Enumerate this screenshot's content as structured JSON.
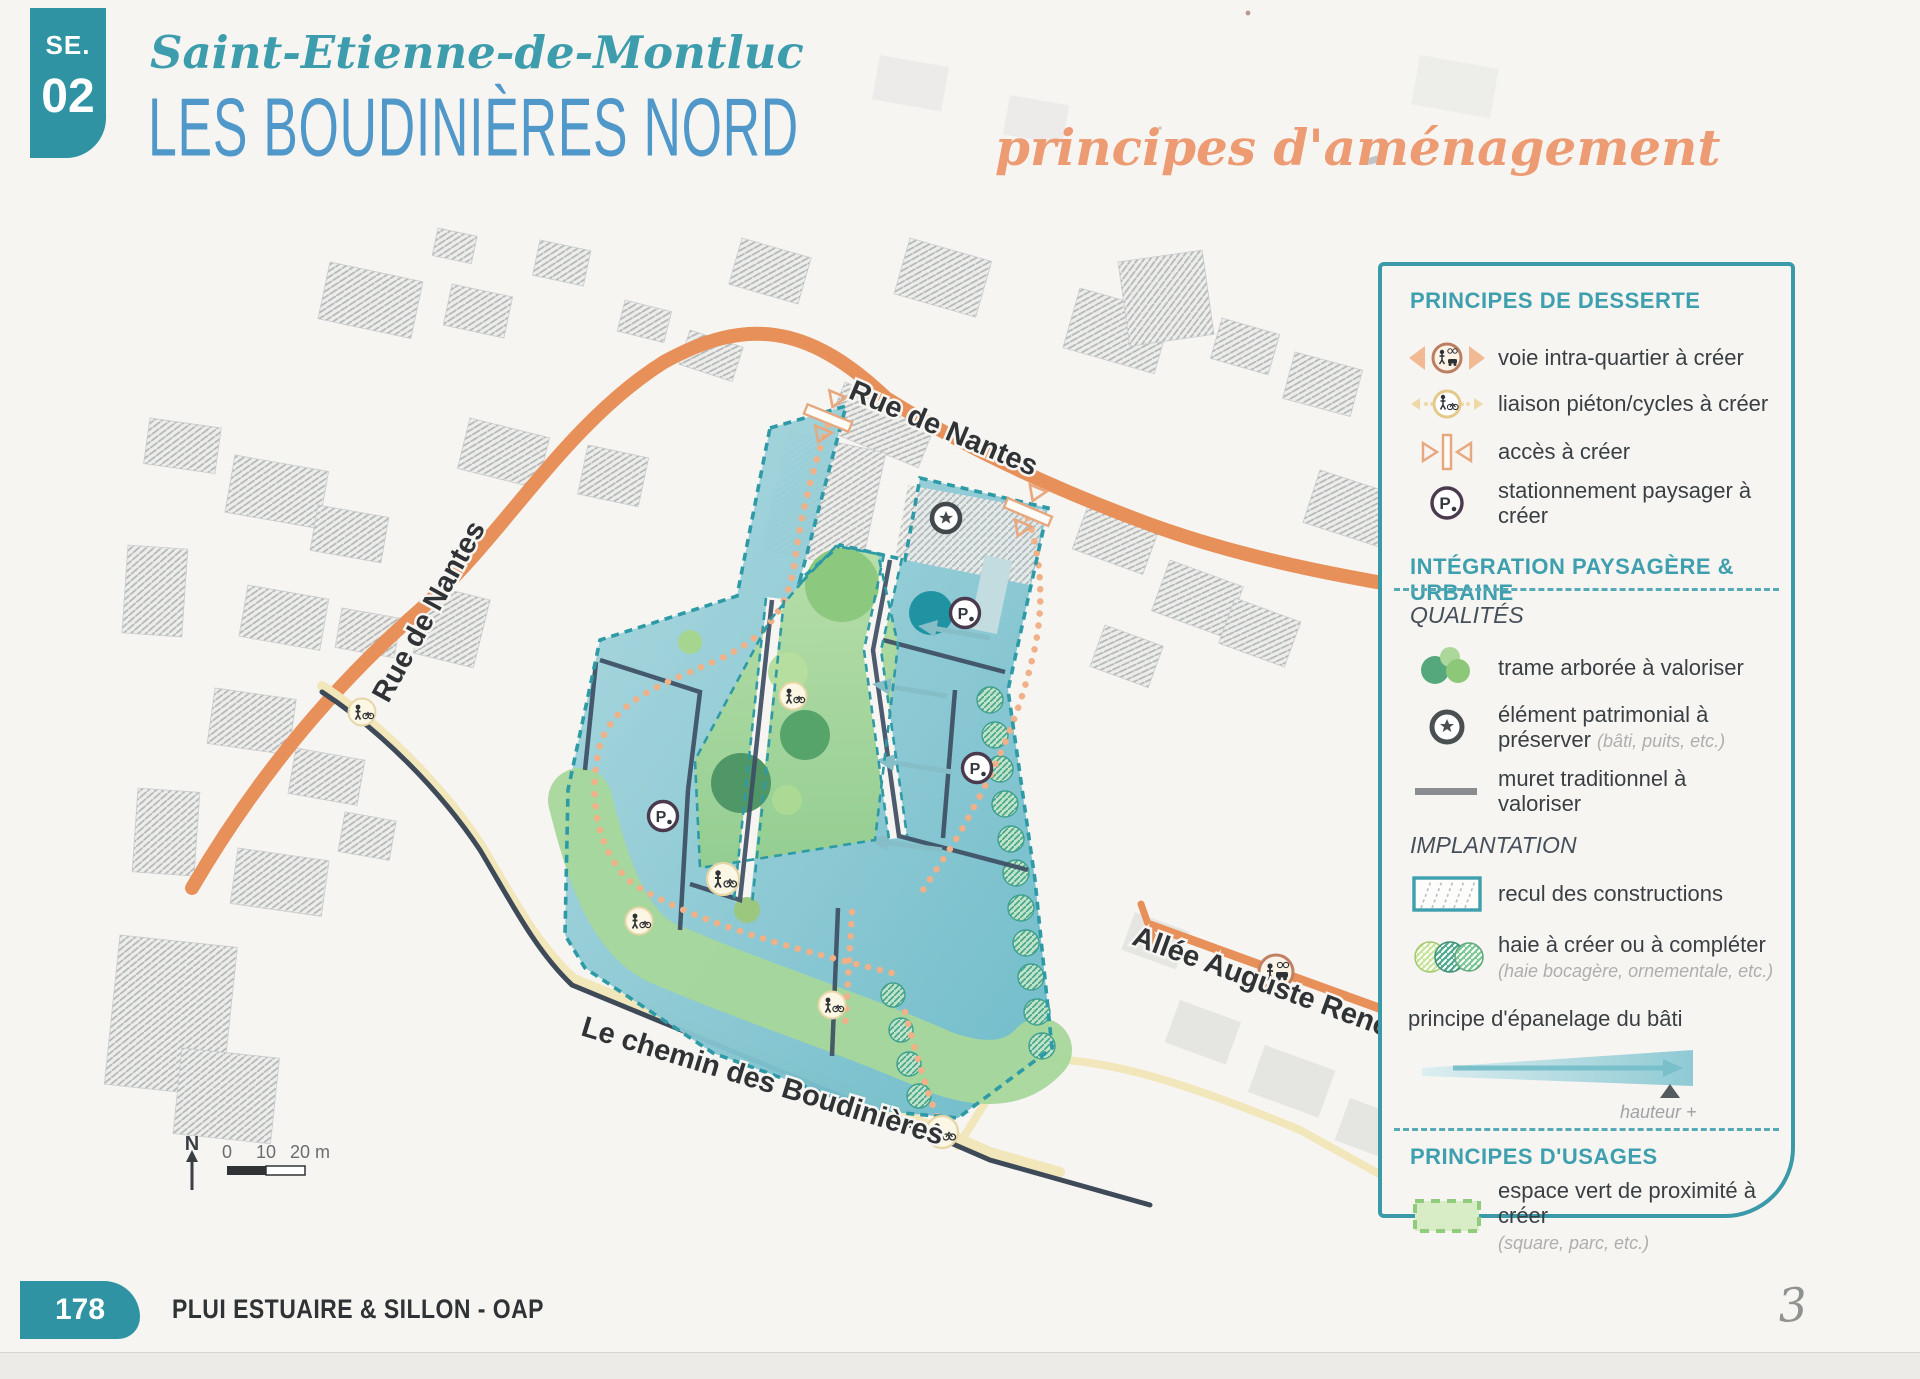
{
  "header": {
    "badge_top": "SE.",
    "badge_num": "02",
    "commune": "Saint-Etienne-de-Montluc",
    "title": "LES BOUDINIÈRES NORD",
    "subtitle": "principes d'aménagement"
  },
  "map": {
    "label_rue_de_nantes_top": "Rue de Nantes",
    "label_rue_de_nantes_left": "Rue de Nantes",
    "label_allee": "Allée Auguste Renoir",
    "label_chemin": "Le chemin des Boudinières",
    "north": "N",
    "scale_0": "0",
    "scale_10": "10",
    "scale_20": "20 m",
    "parking_letter": "P"
  },
  "legend": {
    "s1_title": "PRINCIPES DE DESSERTE",
    "s1_i1": "voie intra-quartier à créer",
    "s1_i2": "liaison piéton/cycles à créer",
    "s1_i3": "accès à créer",
    "s1_i4": "stationnement paysager à créer",
    "s2_title": "INTÉGRATION PAYSAGÈRE & URBAINE",
    "s2_sub": "QUALITÉS",
    "s2_i1": "trame arborée à valoriser",
    "s2_i2": "élément patrimonial à préserver",
    "s2_i2_note": "(bâti, puits, etc.)",
    "s2_i3": "muret traditionnel à valoriser",
    "s3_sub": "IMPLANTATION",
    "s3_i1": "recul des constructions",
    "s3_i2": "haie à créer ou à compléter",
    "s3_i2_note": "(haie bocagère, ornementale, etc.)",
    "s3_i3": "principe d'épanelage du bâti",
    "s3_i3_note": "hauteur +",
    "s4_title": "PRINCIPES D'USAGES",
    "s4_i1": "espace vert de proximité à créer",
    "s4_i1_note": "(square, parc, etc.)",
    "p_letter": "P"
  },
  "footer": {
    "page": "178",
    "doc_title": "PLUI ESTUAIRE & SILLON - OAP",
    "handwritten_note": "3"
  },
  "colors": {
    "teal": "#2F93A3",
    "title_blue": "#4F98C9",
    "orange_script": "#EC9B72",
    "road_orange": "#E89059",
    "legend_teal": "#3E9FAE",
    "site_border": "#2E9AA6"
  }
}
